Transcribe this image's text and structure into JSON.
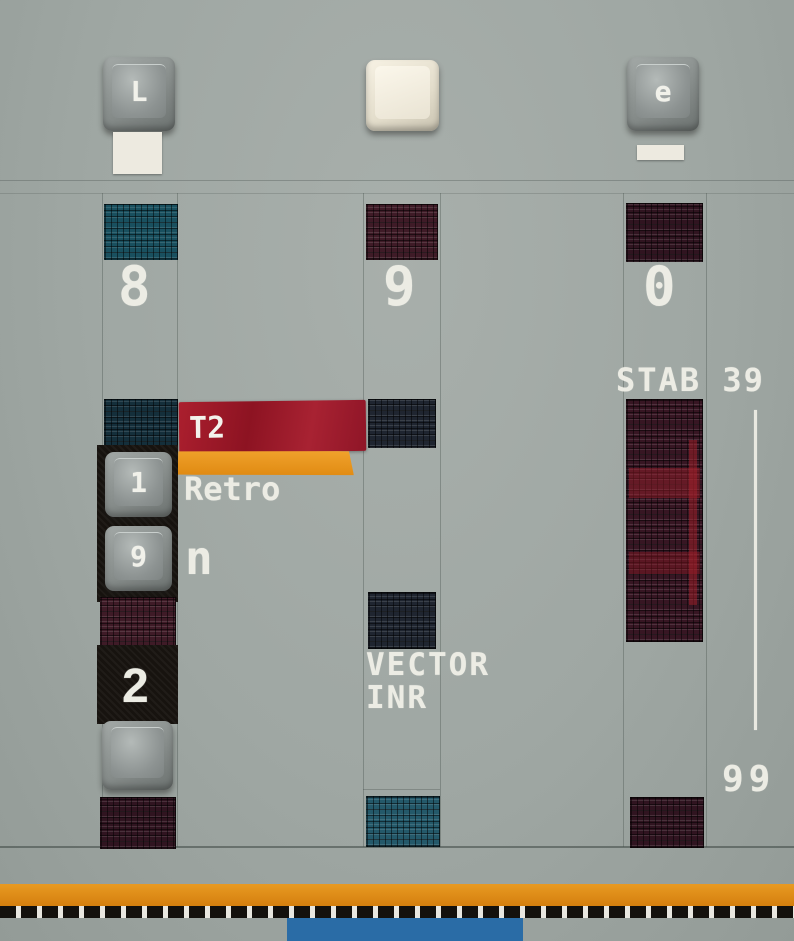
{
  "top_keys": {
    "left_glyph": "L",
    "middle_glyph": "",
    "right_glyph": "e"
  },
  "left_column": {
    "digit": "8",
    "upper_key_glyph": "1",
    "middle_key_glyph": "9",
    "bottom_key_glyph": "",
    "section_number": "2"
  },
  "middle_column": {
    "digit": "9",
    "label_line1": "VECTOR",
    "label_line2": "INR"
  },
  "right_column": {
    "digit": "0",
    "title": "STAB 39",
    "bottom_number": "99"
  },
  "tape_labels": {
    "red_tape_text": "T2",
    "retro_text": "Retro",
    "n_text": "n"
  },
  "colors": {
    "panel_gray": "#9fa7a3",
    "red_tape": "#9e1826",
    "orange_tape": "#e79420",
    "bottom_orange_stripe": "#dd8714",
    "bottom_blue_block": "#2a6ca6",
    "texture_teal": "#19505f",
    "texture_navy": "#1f2530",
    "texture_maroon": "#3f1b27",
    "stencil_white": "#ecece4"
  }
}
